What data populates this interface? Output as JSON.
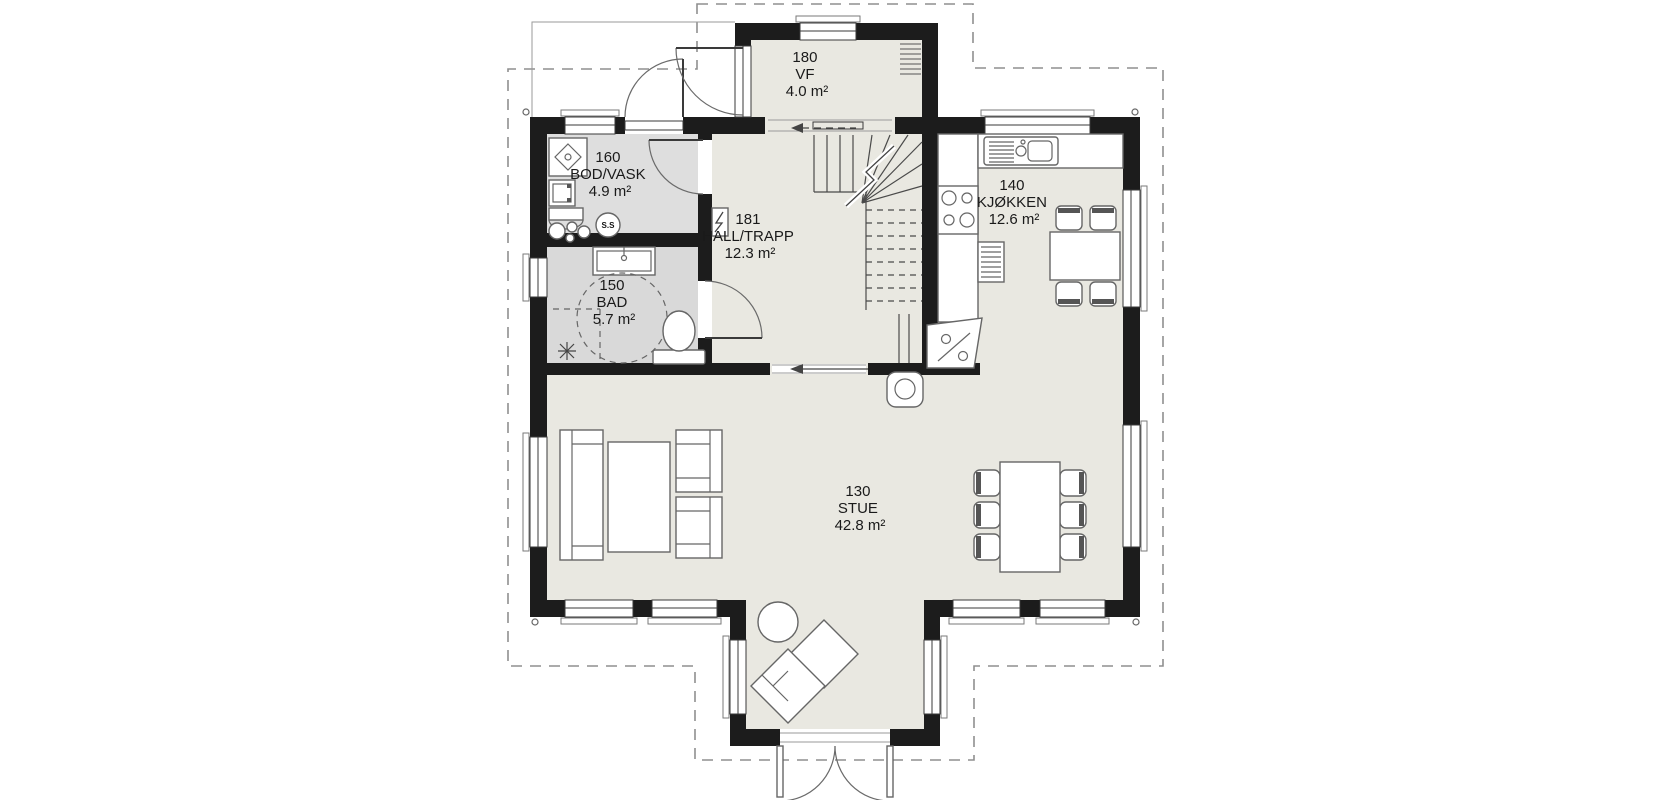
{
  "meta": {
    "drawing_type": "architectural floor plan, ground floor"
  },
  "colors": {
    "wall": "#1c1c1c",
    "floor": "#e9e8e1",
    "wet": "#dedede",
    "wet2": "#d9d9d9",
    "line": "#666666",
    "dash": "#8f8f8f",
    "text": "#1a1a1a"
  },
  "rooms": [
    {
      "number": "180",
      "name": "VF",
      "area": "4.0 m²"
    },
    {
      "number": "160",
      "name": "BOD/VASK",
      "area": "4.9 m²"
    },
    {
      "number": "181",
      "name": "HALL/TRAPP",
      "area": "12.3 m²"
    },
    {
      "number": "140",
      "name": "KJØKKEN",
      "area": "12.6 m²"
    },
    {
      "number": "150",
      "name": "BAD",
      "area": "5.7 m²"
    },
    {
      "number": "130",
      "name": "STUE",
      "area": "42.8 m²"
    }
  ],
  "fixtures": {
    "water_heater_label": "S.S"
  }
}
